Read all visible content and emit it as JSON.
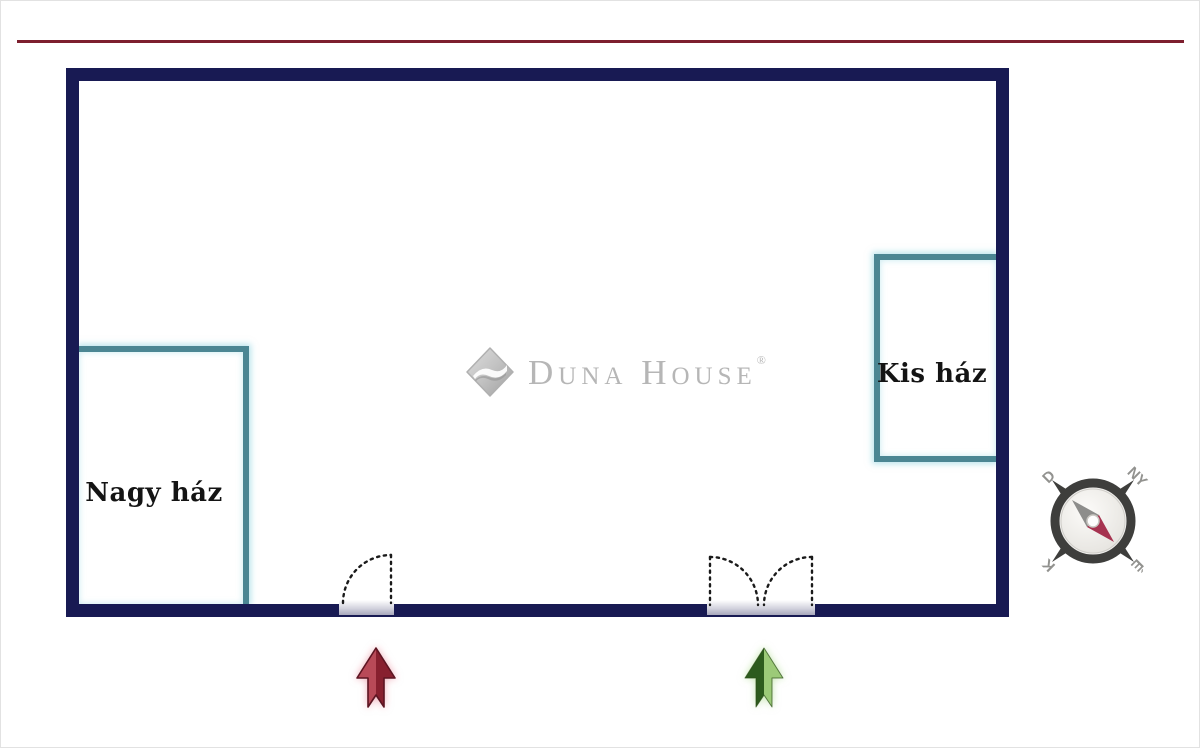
{
  "page": {
    "type": "property-floor-plan",
    "background": "#ffffff"
  },
  "top_line": {
    "color": "#7d1f2e"
  },
  "plan": {
    "wall_color": "#181a53",
    "room_outline_color": "#4b8693",
    "rooms": [
      {
        "label": "Nagy ház"
      },
      {
        "label": "Kis ház"
      }
    ],
    "doors": [
      {
        "name": "single-door"
      },
      {
        "name": "double-door"
      }
    ]
  },
  "watermark": {
    "brand": "Duna House",
    "registered": "®"
  },
  "arrows": [
    {
      "name": "red-entrance-arrow",
      "color_left": "#b84a58",
      "color_right": "#87202f",
      "outline": "#5c1522"
    },
    {
      "name": "green-entrance-arrow",
      "color_left": "#2d5b1d",
      "color_right": "#9cca78",
      "outline": "#2a4d16"
    }
  ],
  "compass": {
    "south_label": "D",
    "west_label": "NY",
    "east_label": "K",
    "north_label": "É",
    "needle_colors": {
      "tail": "#8d8d8b",
      "north": "#a63350"
    }
  }
}
